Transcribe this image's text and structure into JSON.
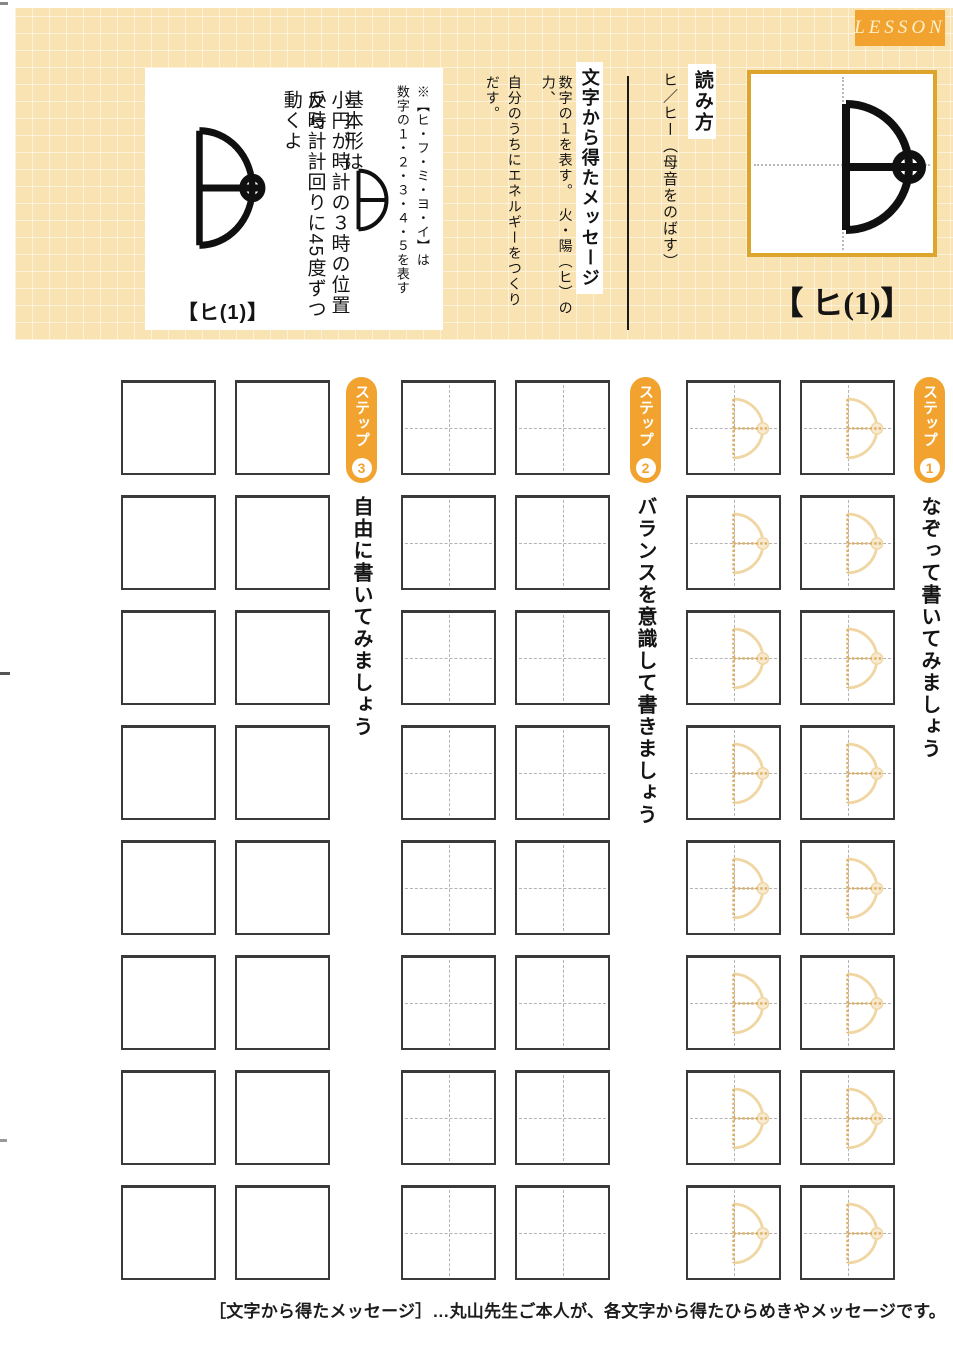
{
  "page": {
    "lesson_tag": "LESSON",
    "footnote": "［文字から得たメッセージ］…丸山先生ご本人が、各文字から得たひらめきやメッセージです。"
  },
  "header": {
    "character_title": "【 ヒ(1)】",
    "reading": {
      "heading": "読み方",
      "text": "ヒ／ヒー（母音をのばす）"
    },
    "message": {
      "heading": "文字から得たメッセージ",
      "lines": [
        "数字の１を表す。　火・陽（ヒ）の力、",
        "自分のうちにエネルギーをつくり",
        "だす。"
      ]
    },
    "info_box": {
      "note_lines": [
        "※【ヒ・フ・ミ・ヨ・イ】は",
        "数字の１・２・３・４・５を表す"
      ],
      "basic_form_label": "基本形は",
      "explain_lines": [
        "小円が時計の３時の位置から",
        "反時計計回りに45度ずつ動くよ"
      ],
      "caption": "【ヒ(1)】"
    }
  },
  "practice": {
    "rows": 8,
    "step_label": "ステップ",
    "steps": [
      {
        "number": "1",
        "instruction": "なぞって書いてみましょう",
        "square_type": "traced"
      },
      {
        "number": "2",
        "instruction": "バランスを意識して書きましょう",
        "square_type": "guides"
      },
      {
        "number": "3",
        "instruction": "自由に書いてみましょう",
        "square_type": "plain"
      }
    ]
  },
  "colors": {
    "band-bg": "#fae3b3",
    "accent": "#f2a32f",
    "gold-border": "#dda42e",
    "lesson-text": "#faf0cb",
    "trace": "#f0d6a2",
    "trace-strong": "#ddae62",
    "guide": "#b3b3b3",
    "square-border": "#3a3a3a",
    "ink": "#141414"
  }
}
